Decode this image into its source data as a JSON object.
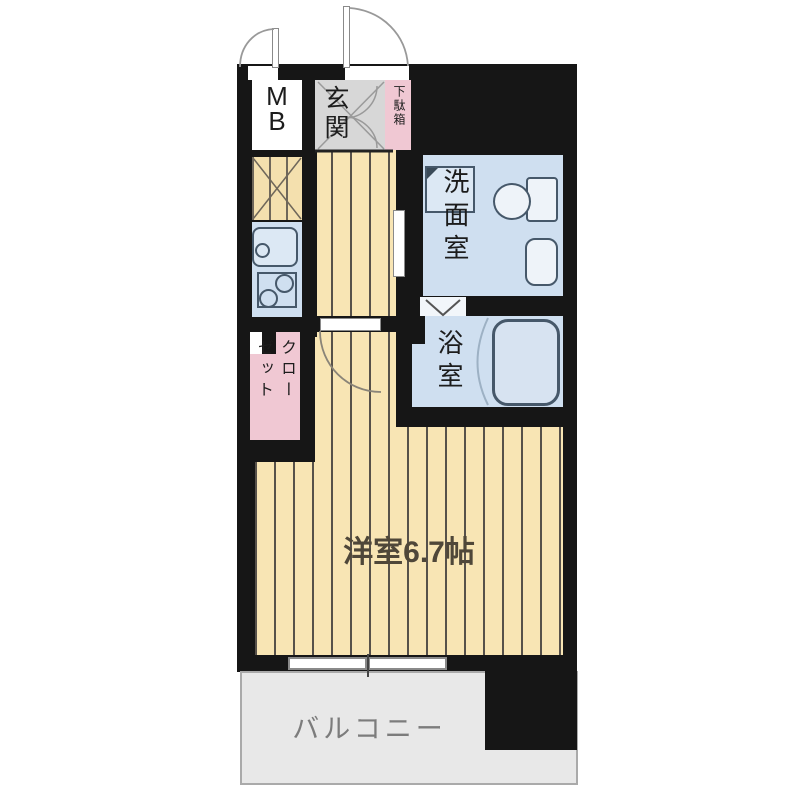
{
  "plan_title": "apartment-floor-plan",
  "rooms": {
    "mb": {
      "label": "M\nB"
    },
    "genkan": {
      "label": "玄関"
    },
    "getabako": {
      "label": "下駄箱"
    },
    "washroom": {
      "label": "洗面室"
    },
    "bathroom": {
      "label": "浴室"
    },
    "closet": {
      "label": "クロー\nゼット"
    },
    "western_room": {
      "label": "洋室6.7帖",
      "size_tatami": "6.7"
    },
    "balcony": {
      "label": "バルコニー"
    }
  },
  "fixtures": [
    "entrance-door",
    "mb-door",
    "shoe-cabinet-doors",
    "washing-machine",
    "toilet",
    "washroom-sink",
    "bathtub",
    "kitchen-sink",
    "stove",
    "room-door",
    "bath-folding-door",
    "sliding-window",
    "refrigerator-space"
  ],
  "colors": {
    "wall": "#161616",
    "wet_area_floor": "#cfdff0",
    "storage_pink": "#f0c8d3",
    "wood_floor": "#f8e5b4",
    "wood_floor_stripe": "#57514a",
    "genkan_tile": "#d7d7d7",
    "balcony_floor": "#e8e8e8",
    "room_label_text": "#4f4739",
    "balcony_label_text": "#7c7c7c"
  }
}
